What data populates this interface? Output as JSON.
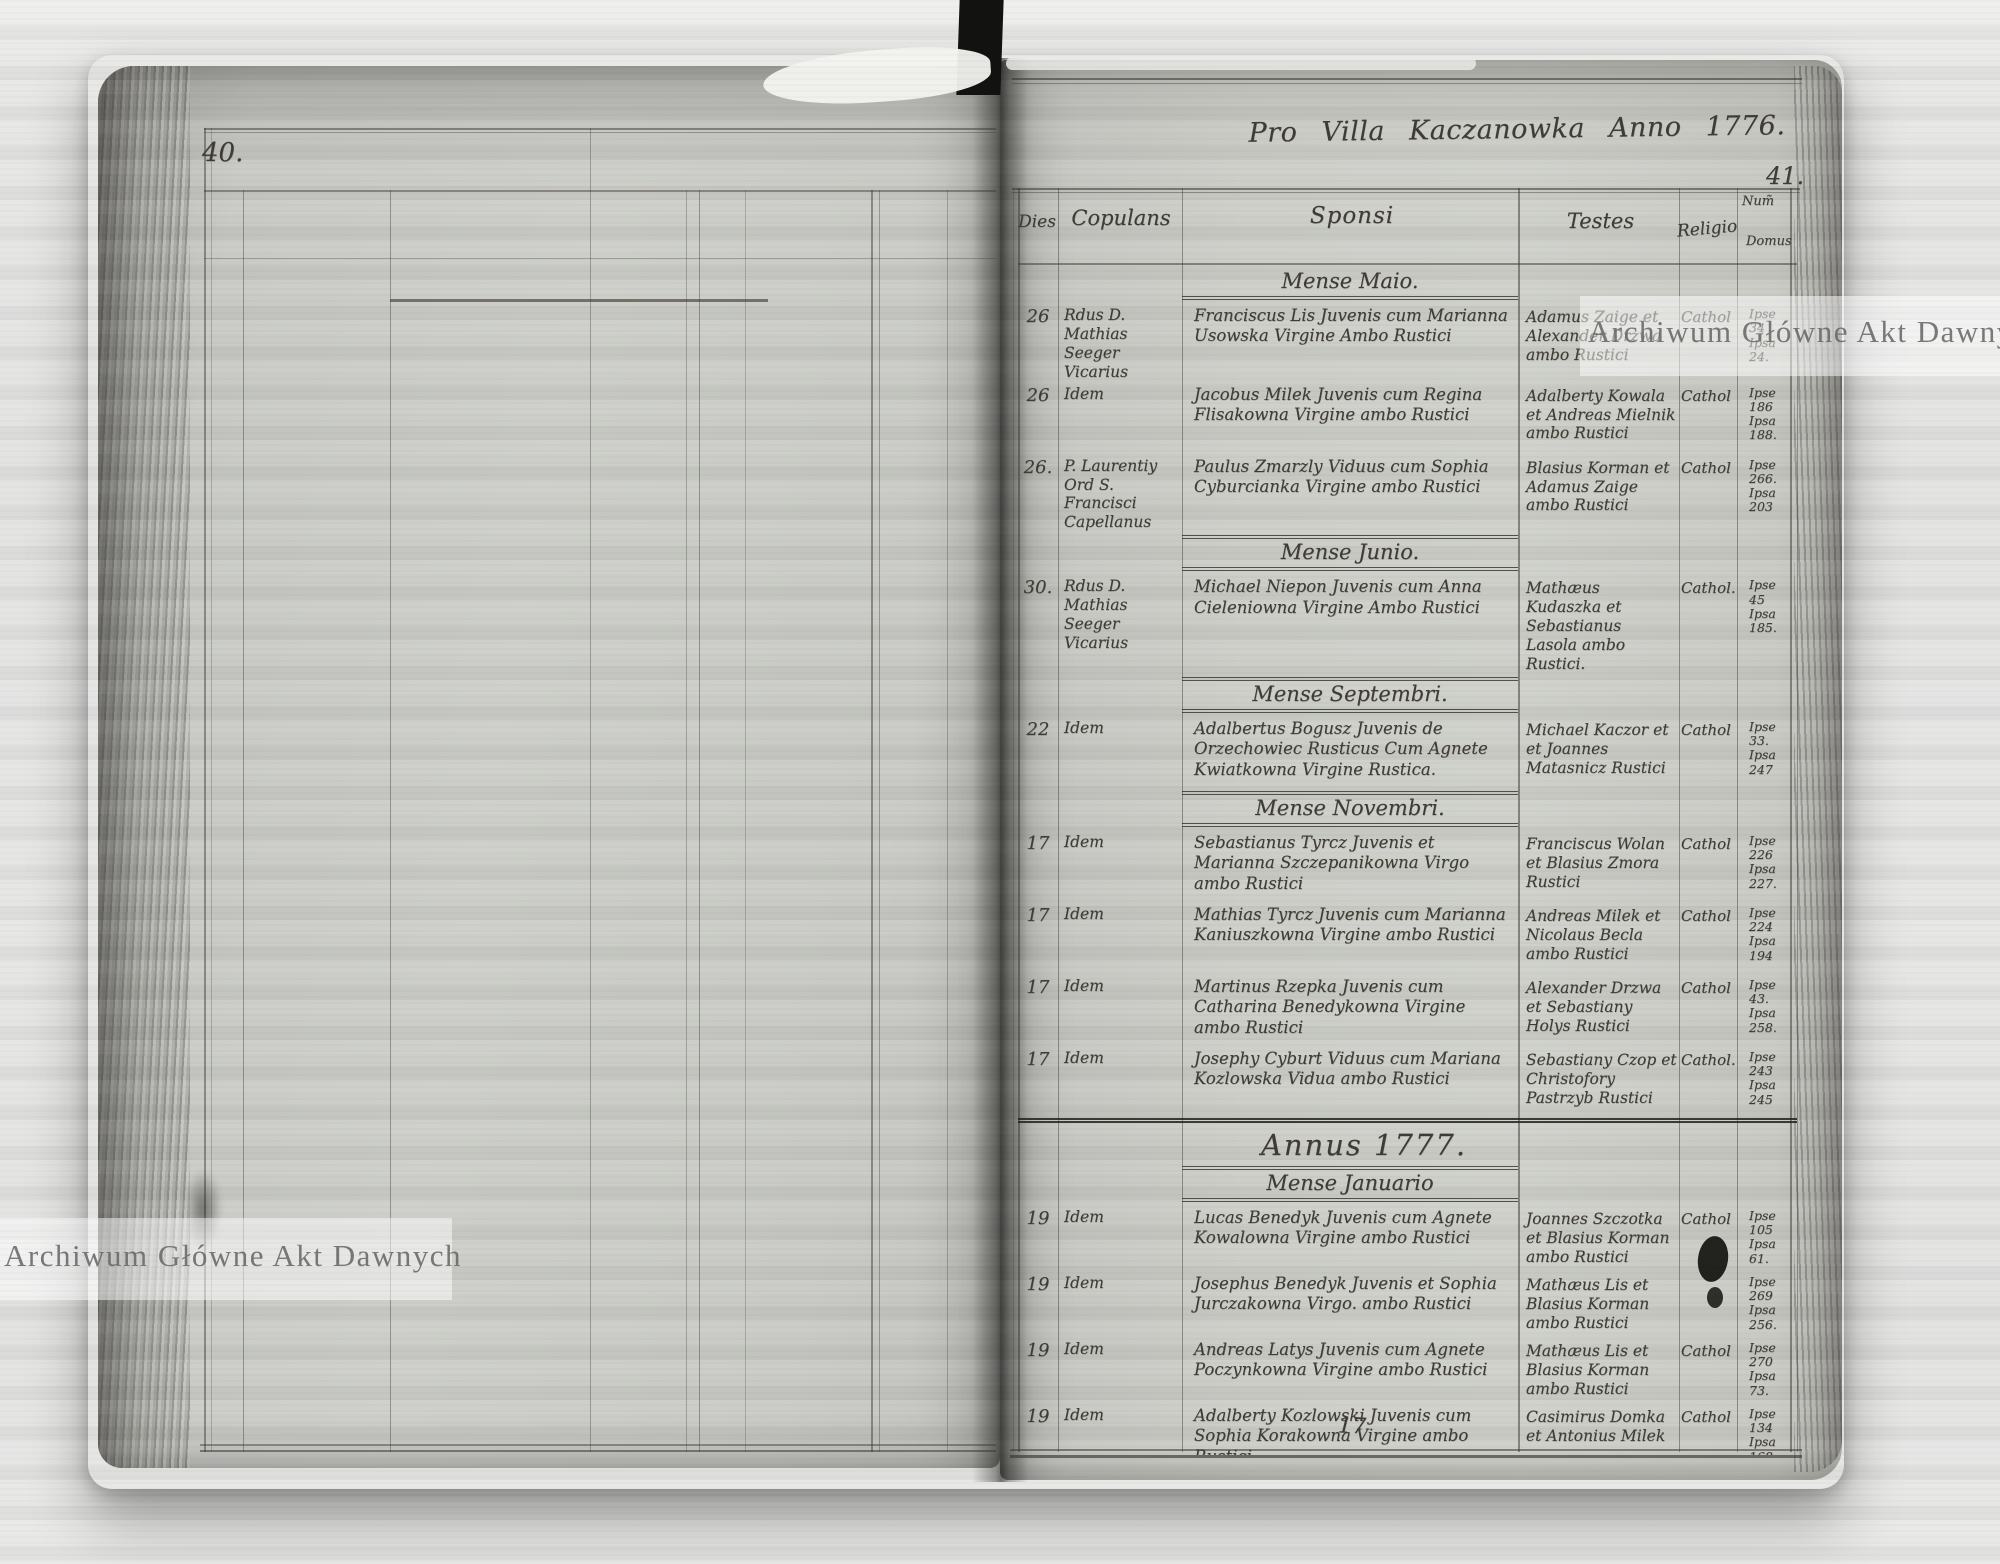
{
  "scan": {
    "watermark_text": "Archiwum Główne Akt Dawnych",
    "left_page": {
      "page_number": "40."
    },
    "right_page": {
      "page_number": "41.",
      "title": "Pro Villa Kaczanowka Anno 1776.",
      "bottom_mark": "17",
      "columns": {
        "dies": "Dies",
        "copulans": "Copulans",
        "sponsi": "Sponsi",
        "testes": "Testes",
        "religio": "Religio",
        "num_line1": "Num̃",
        "num_line2": "Domus"
      },
      "sections": [
        {
          "header": "Mense Maio.",
          "type": "month",
          "rows": [
            {
              "dies": "26",
              "copulans": "Rdus D. Mathias Seeger Vicarius",
              "sponsi": "Franciscus Lis Juvenis cum Marianna Usowska Virgine Ambo Rustici",
              "testes": "Adamus Zaige et Alexander Drzwa ambo Rustici",
              "religio": "Cathol",
              "num": "Ipse\n34\nIpsa\n24."
            },
            {
              "dies": "26",
              "copulans": "Idem",
              "sponsi": "Jacobus Milek Juvenis cum Regina Flisakowna Virgine ambo Rustici",
              "testes": "Adalberty Kowala et Andreas Mielnik ambo Rustici",
              "religio": "Cathol",
              "num": "Ipse\n186\nIpsa\n188."
            },
            {
              "dies": "26.",
              "copulans": "P. Laurentiy Ord S. Francisci Capellanus",
              "sponsi": "Paulus Zmarzly Viduus cum Sophia Cyburcianka Virgine ambo Rustici",
              "testes": "Blasius Korman et Adamus Zaige ambo Rustici",
              "religio": "Cathol",
              "num": "Ipse\n266.\nIpsa\n203"
            }
          ]
        },
        {
          "header": "Mense Junio.",
          "type": "month",
          "rows": [
            {
              "dies": "30.",
              "copulans": "Rdus D. Mathias Seeger Vicarius",
              "sponsi": "Michael Niepon Juvenis cum Anna Cieleniowna Virgine Ambo Rustici",
              "testes": "Mathæus Kudaszka et Sebastianus Lasola ambo Rustici.",
              "religio": "Cathol.",
              "num": "Ipse\n45\nIpsa\n185."
            }
          ]
        },
        {
          "header": "Mense Septembri.",
          "type": "month",
          "rows": [
            {
              "dies": "22",
              "copulans": "Idem",
              "sponsi": "Adalbertus Bogusz Juvenis de Orzechowiec Rusticus Cum Agnete Kwiatkowna Virgine Rustica.",
              "testes": "Michael Kaczor et et Joannes Matasnicz Rustici",
              "religio": "Cathol",
              "num": "Ipse\n33.\nIpsa\n247"
            }
          ]
        },
        {
          "header": "Mense Novembri.",
          "type": "month",
          "rows": [
            {
              "dies": "17",
              "copulans": "Idem",
              "sponsi": "Sebastianus Tyrcz Juvenis et Marianna Szczepanikowna Virgo ambo Rustici",
              "testes": "Franciscus Wolan et Blasius Zmora Rustici",
              "religio": "Cathol",
              "num": "Ipse\n226\nIpsa\n227."
            },
            {
              "dies": "17",
              "copulans": "Idem",
              "sponsi": "Mathias Tyrcz Juvenis cum Marianna Kaniuszkowna Virgine ambo Rustici",
              "testes": "Andreas Milek et Nicolaus Becla ambo Rustici",
              "religio": "Cathol",
              "num": "Ipse\n224\nIpsa\n194"
            },
            {
              "dies": "17",
              "copulans": "Idem",
              "sponsi": "Martinus Rzepka Juvenis cum Catharina Benedykowna Virgine ambo Rustici",
              "testes": "Alexander Drzwa et Sebastiany Holys Rustici",
              "religio": "Cathol",
              "num": "Ipse\n43.\nIpsa\n258."
            },
            {
              "dies": "17",
              "copulans": "Idem",
              "sponsi": "Josephy Cyburt Viduus cum Mariana Kozlowska Vidua ambo Rustici",
              "testes": "Sebastiany Czop et Christofory Pastrzyb Rustici",
              "religio": "Cathol.",
              "num": "Ipse\n243\nIpsa\n245"
            }
          ]
        },
        {
          "header": "Annus 1777.",
          "type": "year",
          "rows": []
        },
        {
          "header": "Mense Januario",
          "type": "month",
          "rows": [
            {
              "dies": "19",
              "copulans": "Idem",
              "sponsi": "Lucas Benedyk Juvenis cum Agnete Kowalowna Virgine ambo Rustici",
              "testes": "Joannes Szczotka et Blasius Korman ambo Rustici",
              "religio": "Cathol",
              "num": "Ipse\n105\nIpsa\n61."
            },
            {
              "dies": "19",
              "copulans": "Idem",
              "sponsi": "Josephus Benedyk Juvenis et Sophia Jurczakowna Virgo. ambo Rustici",
              "testes": "Mathæus Lis et Blasius Korman ambo Rustici",
              "religio": "",
              "num": "Ipse\n269\nIpsa\n256."
            },
            {
              "dies": "19",
              "copulans": "Idem",
              "sponsi": "Andreas Latys Juvenis cum Agnete Poczynkowna Virgine ambo Rustici",
              "testes": "Mathæus Lis et Blasius Korman ambo Rustici",
              "religio": "Cathol",
              "num": "Ipse\n270\nIpsa\n73."
            },
            {
              "dies": "19",
              "copulans": "Idem",
              "sponsi": "Adalberty Kozlowski Juvenis cum Sophia Korakowna Virgine ambo Rustici",
              "testes": "Casimirus Domka et Antonius Milek",
              "religio": "Cathol",
              "num": "Ipse\n134\nIpsa\n168"
            },
            {
              "dies": "19",
              "copulans": "Idem",
              "sponsi": "Sebestianus Kolodzieyczuk Juvenis cum Magdalena Osowska Virgine ambo Rustici",
              "testes": "Josephus Burkowski Lucas Kolcz ambo Rustici",
              "religio": "Cathol",
              "num": "Ipse\n137\nIpsa\n64."
            }
          ]
        }
      ]
    },
    "colors": {
      "paper": "#cdcec9",
      "ink": "#3e3c34",
      "rule": "#38352d",
      "watermark_text_color": "#686868"
    }
  }
}
